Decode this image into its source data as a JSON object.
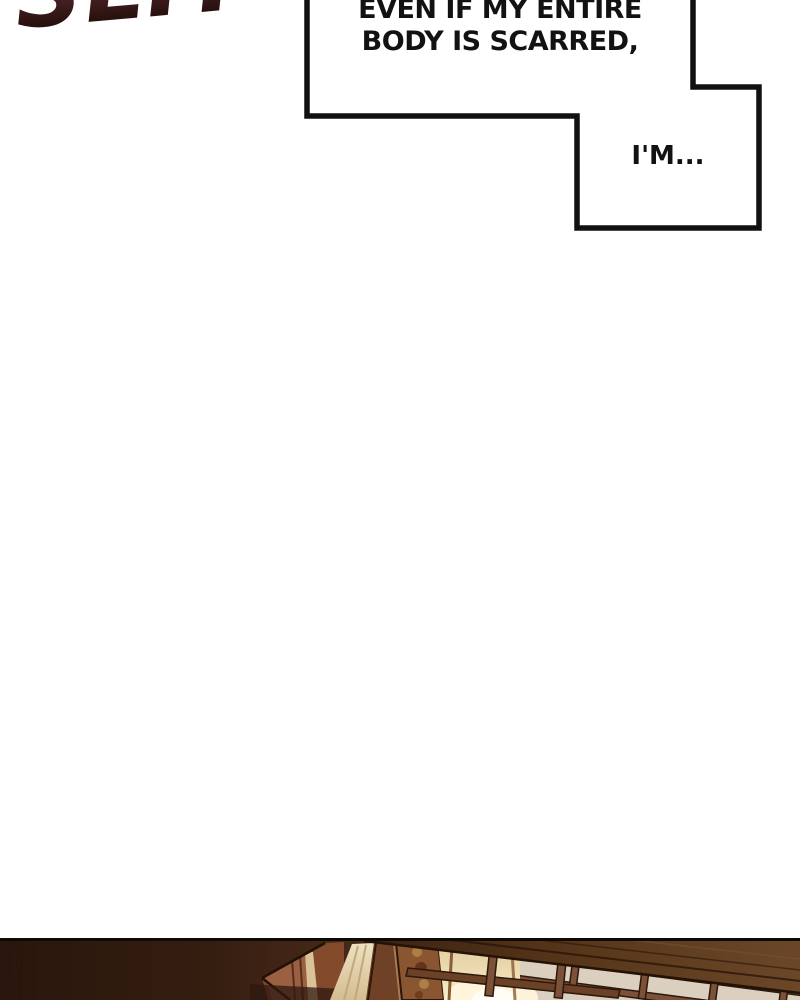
{
  "sfx": {
    "text": "SLIT"
  },
  "speech_bubble_1": {
    "line1": "EVEN IF MY ENTIRE",
    "line2": "BODY IS SCARRED,"
  },
  "speech_bubble_2": {
    "text": "I'M..."
  },
  "colors": {
    "sfx_gradient_top": "#77404e",
    "sfx_gradient_bottom": "#140604",
    "bubble_outline": "#111111",
    "bubble_fill": "#ffffff",
    "panel_border": "#0d0a08",
    "panel_shadow_left": "#2e1a10",
    "panel_wood_beam": "#654122",
    "panel_lattice_background": "#dbcfbf",
    "panel_lattice_bar": "#7b5138",
    "panel_curtain": "#e9dcb9",
    "panel_ornate_gold": "#b08448",
    "panel_terracotta": "#9a5f41",
    "panel_lamp_glow": "#fff6dd"
  }
}
